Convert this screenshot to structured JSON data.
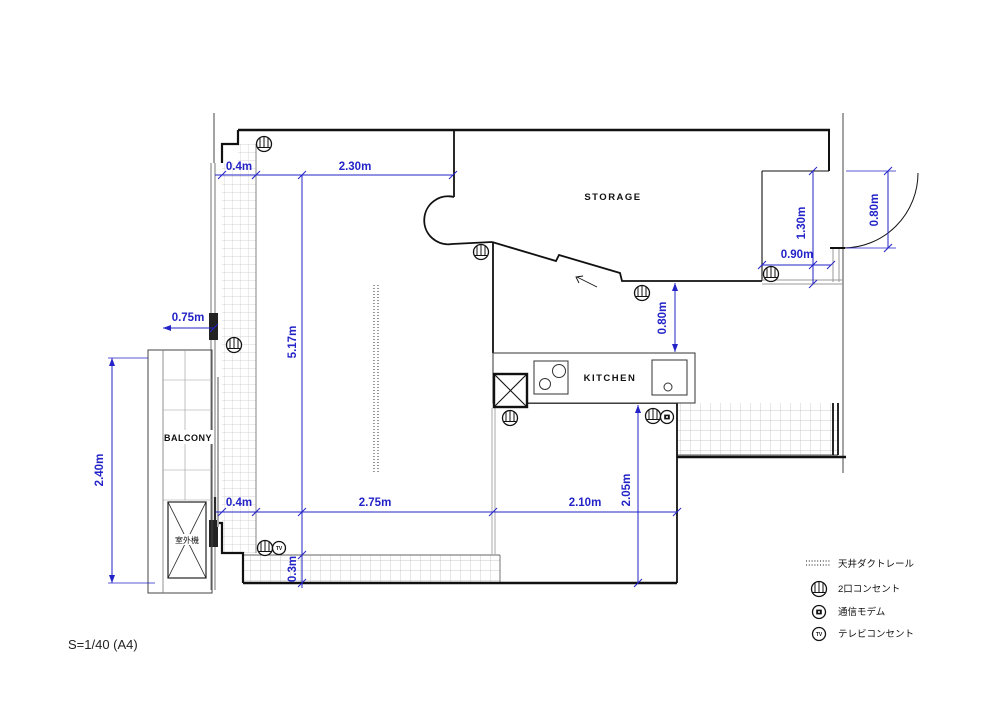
{
  "scale_note": "S=1/40 (A4)",
  "rooms": {
    "storage": "STORAGE",
    "kitchen": "KITCHEN",
    "balcony": "BALCONY",
    "outdoor_unit": "室外機"
  },
  "dimensions": {
    "wall_top": "0.4m",
    "top_width": "2.30m",
    "room_height": "5.17m",
    "balcony_depth": "0.75m",
    "balcony_length": "2.40m",
    "wall_bottom": "0.4m",
    "living_width": "2.75m",
    "sill_depth": "0.3m",
    "dining_width": "2.10m",
    "dining_depth": "2.05m",
    "hall_gap": "0.80m",
    "alcove_width": "0.90m",
    "alcove_depth": "1.30m",
    "entry_door": "0.80m"
  },
  "legend": {
    "items": [
      {
        "symbol": "ceiling-duct-rail",
        "label": "天井ダクトレール"
      },
      {
        "symbol": "double-outlet",
        "label": "2口コンセント"
      },
      {
        "symbol": "communication-modem",
        "label": "通信モデム"
      },
      {
        "symbol": "tv-outlet",
        "label": "テレビコンセント"
      }
    ]
  },
  "colors": {
    "dimension_blue": "#2323c8",
    "wall_black": "#111111",
    "structure_gray": "#999999",
    "hatch_gray": "#c9c9c9"
  }
}
